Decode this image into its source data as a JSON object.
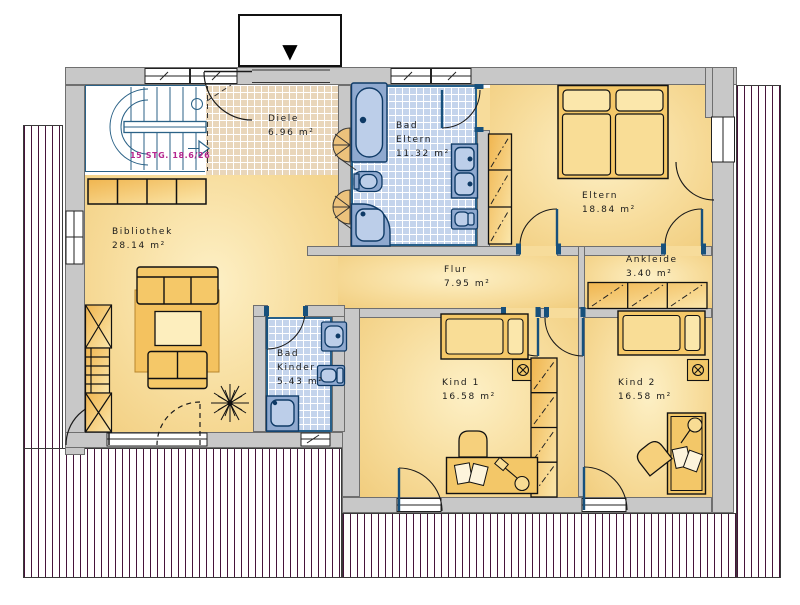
{
  "entrance": {
    "symbol": "▼"
  },
  "stairs": {
    "note": "15 STG. 18.6/26"
  },
  "rooms": {
    "diele": {
      "name": "Diele",
      "area": "6.96 m²"
    },
    "bad_eltern": {
      "name": "Bad",
      "name2": "Eltern",
      "area": "11.32 m²"
    },
    "eltern": {
      "name": "Eltern",
      "area": "18.84 m²"
    },
    "ankleide": {
      "name": "Ankleide",
      "area": "3.40 m²"
    },
    "bibliothek": {
      "name": "Bibliothek",
      "area": "28.14 m²"
    },
    "flur": {
      "name": "Flur",
      "area": "7.95 m²"
    },
    "bad_kinder": {
      "name": "Bad",
      "name2": "Kinder",
      "area": "5.43 m²"
    },
    "kind1": {
      "name": "Kind 1",
      "area": "16.58 m²"
    },
    "kind2": {
      "name": "Kind 2",
      "area": "16.58 m²"
    }
  },
  "colors": {
    "floor": "#f7dc9b",
    "tile_blue": "#c4d4ec",
    "tile_tan": "#e9d6ba",
    "wall": "#c8c8c8",
    "roof_stripe": "#46133a",
    "navy": "#17507c",
    "stair_text": "#b5278f",
    "ink": "#1a1a1a"
  }
}
